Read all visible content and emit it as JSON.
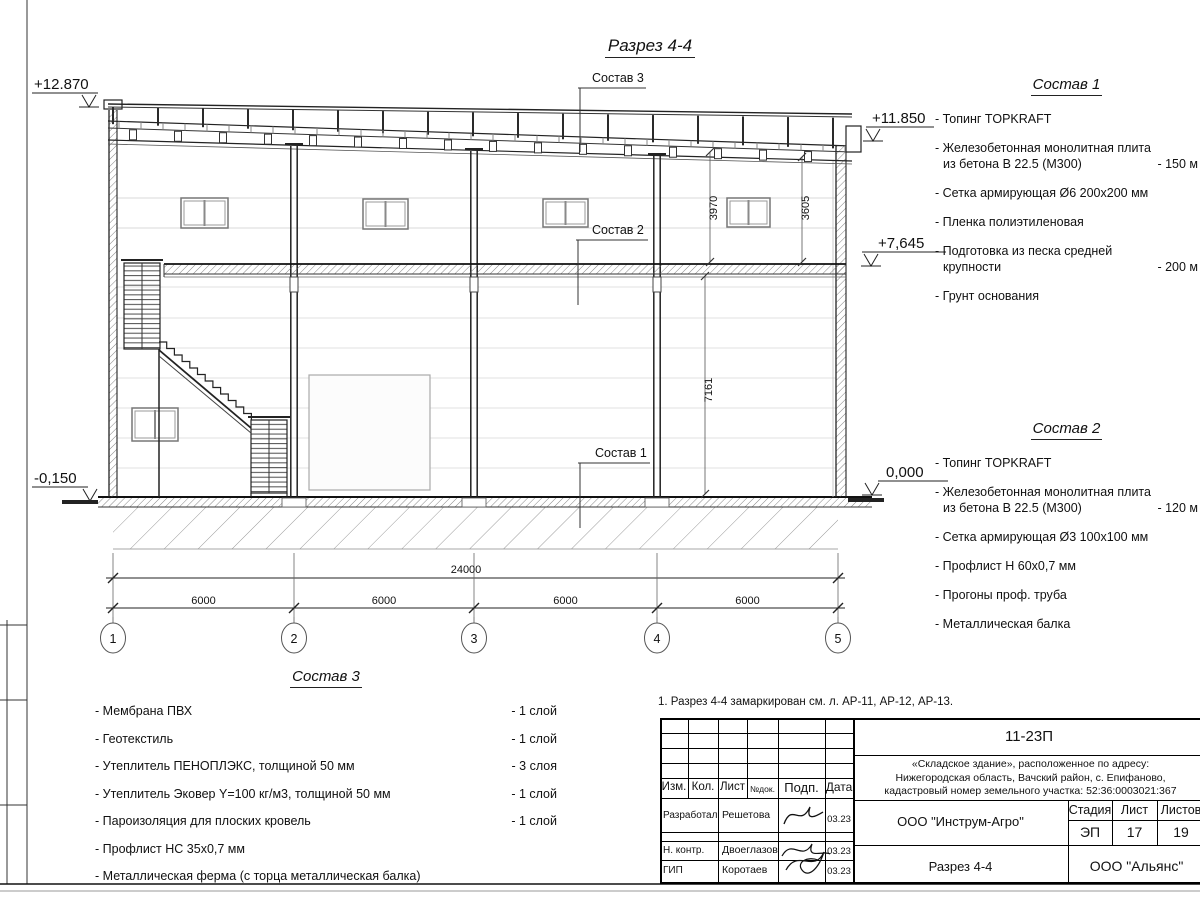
{
  "title": "Разрез 4-4",
  "note": "1. Разрез 4-4 замаркирован см. л. АР-11, АР-12, АР-13.",
  "callouts": {
    "c1": "Состав 1",
    "c2": "Состав 2",
    "c3": "Состав 3"
  },
  "elevations": {
    "parapet_left": "+12.870",
    "roof_right": "+11.850",
    "mezzanine": "+7,645",
    "zero": "0,000",
    "apron_left": "-0,150"
  },
  "dimensions": {
    "total": "24000",
    "bays": [
      "6000",
      "6000",
      "6000",
      "6000"
    ],
    "height_upper_left": "3970",
    "height_upper_right": "3605",
    "height_lower": "7161"
  },
  "axes": [
    "1",
    "2",
    "3",
    "4",
    "5"
  ],
  "compositions": [
    {
      "title": "Состав 1",
      "items": [
        {
          "t1": "- Топинг TOPKRAFT",
          "t2": "",
          "qty": ""
        },
        {
          "t1": "- Железобетонная  монолитная плита",
          "t2": "из бетона  В 22.5 (М300)",
          "qty": "- 150 м"
        },
        {
          "t1": "- Сетка армирующая Ø6 200х200 мм",
          "t2": "",
          "qty": ""
        },
        {
          "t1": "- Пленка полиэтиленовая",
          "t2": "",
          "qty": ""
        },
        {
          "t1": "- Подготовка из песка средней",
          "t2": "крупности",
          "qty": "- 200 м"
        },
        {
          "t1": "- Грунт основания",
          "t2": "",
          "qty": ""
        }
      ]
    },
    {
      "title": "Состав 2",
      "items": [
        {
          "t1": "- Топинг TOPKRAFT",
          "t2": "",
          "qty": ""
        },
        {
          "t1": "- Железобетонная  монолитная плита",
          "t2": "из бетона  В 22.5 (М300)",
          "qty": "- 120 м"
        },
        {
          "t1": "- Сетка армирующая Ø3 100х100 мм",
          "t2": "",
          "qty": ""
        },
        {
          "t1": "- Профлист Н 60х0,7 мм",
          "t2": "",
          "qty": ""
        },
        {
          "t1": "- Прогоны проф. труба",
          "t2": "",
          "qty": ""
        },
        {
          "t1": "- Металлическая балка",
          "t2": "",
          "qty": ""
        }
      ]
    },
    {
      "title": "Состав 3",
      "items": [
        {
          "t1": "- Мембрана ПВХ",
          "t2": "",
          "qty": "- 1 слой"
        },
        {
          "t1": "- Геотекстиль",
          "t2": "",
          "qty": "- 1 слой"
        },
        {
          "t1": "- Утеплитель ПЕНОПЛЭКС, толщиной 50 мм",
          "t2": "",
          "qty": "- 3 слоя"
        },
        {
          "t1": "- Утеплитель Эковер Y=100 кг/м3, толщиной 50 мм",
          "t2": "",
          "qty": "- 1 слой"
        },
        {
          "t1": "- Пароизоляция для плоских кровель",
          "t2": "",
          "qty": "- 1 слой"
        },
        {
          "t1": "- Профлист НС 35х0,7 мм",
          "t2": "",
          "qty": ""
        },
        {
          "t1": "- Металлическая ферма (с торца металлическая балка)",
          "t2": "",
          "qty": ""
        }
      ]
    }
  ],
  "titleblock": {
    "doc_code": "11-23П",
    "project": "«Складское здание», расположенное по адресу:\nНижегородская область, Вачский район, с. Епифаново,\nкадастровый номер земельного участка: 52:36:0003021:367",
    "headers": {
      "izm": "Изм.",
      "kol": "Кол.",
      "list": "Лист",
      "ndoc": "№док.",
      "podp": "Подп.",
      "data": "Дата"
    },
    "rows": [
      {
        "role": "Разработал",
        "name": "Решетова",
        "date": "03.23"
      },
      {
        "role": "Н. контр.",
        "name": "Двоеглазов",
        "date": "03.23"
      },
      {
        "role": "ГИП",
        "name": "Коротаев",
        "date": "03.23"
      }
    ],
    "org": "ООО \"Инструм-Агро\"",
    "stage_label": "Стадия",
    "sheet_label": "Лист",
    "sheets_label": "Листов",
    "stage": "ЭП",
    "sheet": "17",
    "sheets": "19",
    "drawing_name": "Разрез 4-4",
    "contractor": "ООО \"Альянс\""
  },
  "colors": {
    "line": "#1a1a1a",
    "light_line": "#d0d0d0",
    "hatch": "#666666"
  }
}
